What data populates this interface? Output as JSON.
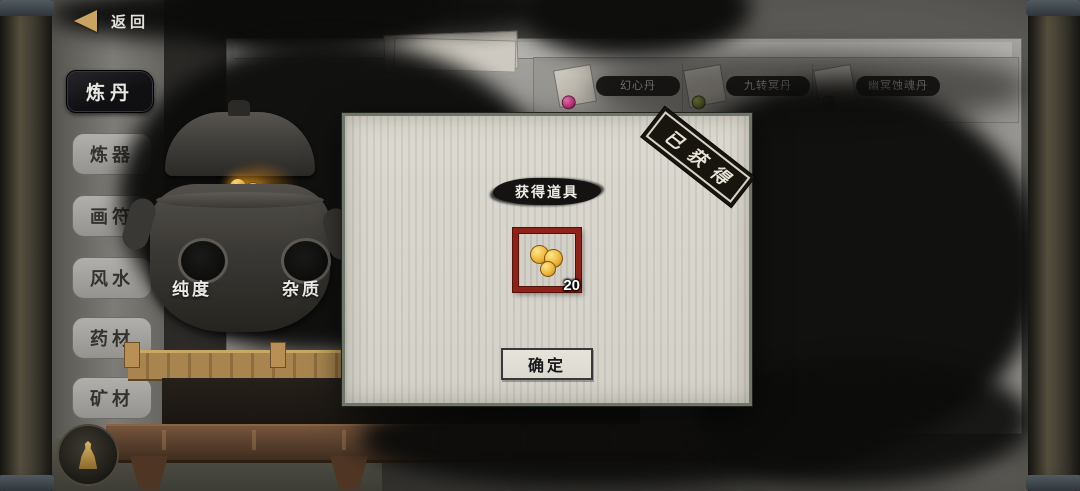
{
  "topbar": {
    "back_label": "返回"
  },
  "sidebar": {
    "items": [
      {
        "label": "炼丹",
        "active": true
      },
      {
        "label": "炼器",
        "active": false
      },
      {
        "label": "画符",
        "active": false
      },
      {
        "label": "风水",
        "active": false
      },
      {
        "label": "药材",
        "active": false
      },
      {
        "label": "矿材",
        "active": false
      }
    ]
  },
  "furnace": {
    "purity_label": "纯度",
    "impurity_label": "杂质"
  },
  "recipes": [
    {
      "label": "幻心丹",
      "pill_color": "#c2327a"
    },
    {
      "label": "九转冥丹",
      "pill_color": "#6f7e2e"
    },
    {
      "label": "幽冥蚀魂丹",
      "pill_color": "#2c6f68"
    }
  ],
  "modal": {
    "title": "获得道具",
    "stamp": "已获得",
    "item": {
      "icon": "gold-pills-icon",
      "count": "20"
    },
    "confirm_label": "确定"
  },
  "colors": {
    "slot_frame_red": "#8e2118",
    "pill_gold": "#edb93b",
    "modal_paper": "#d8d5cd",
    "ink_black": "#0c0c0b",
    "stamp_black": "#18150f",
    "back_arrow_gold": "#c9a35f"
  }
}
